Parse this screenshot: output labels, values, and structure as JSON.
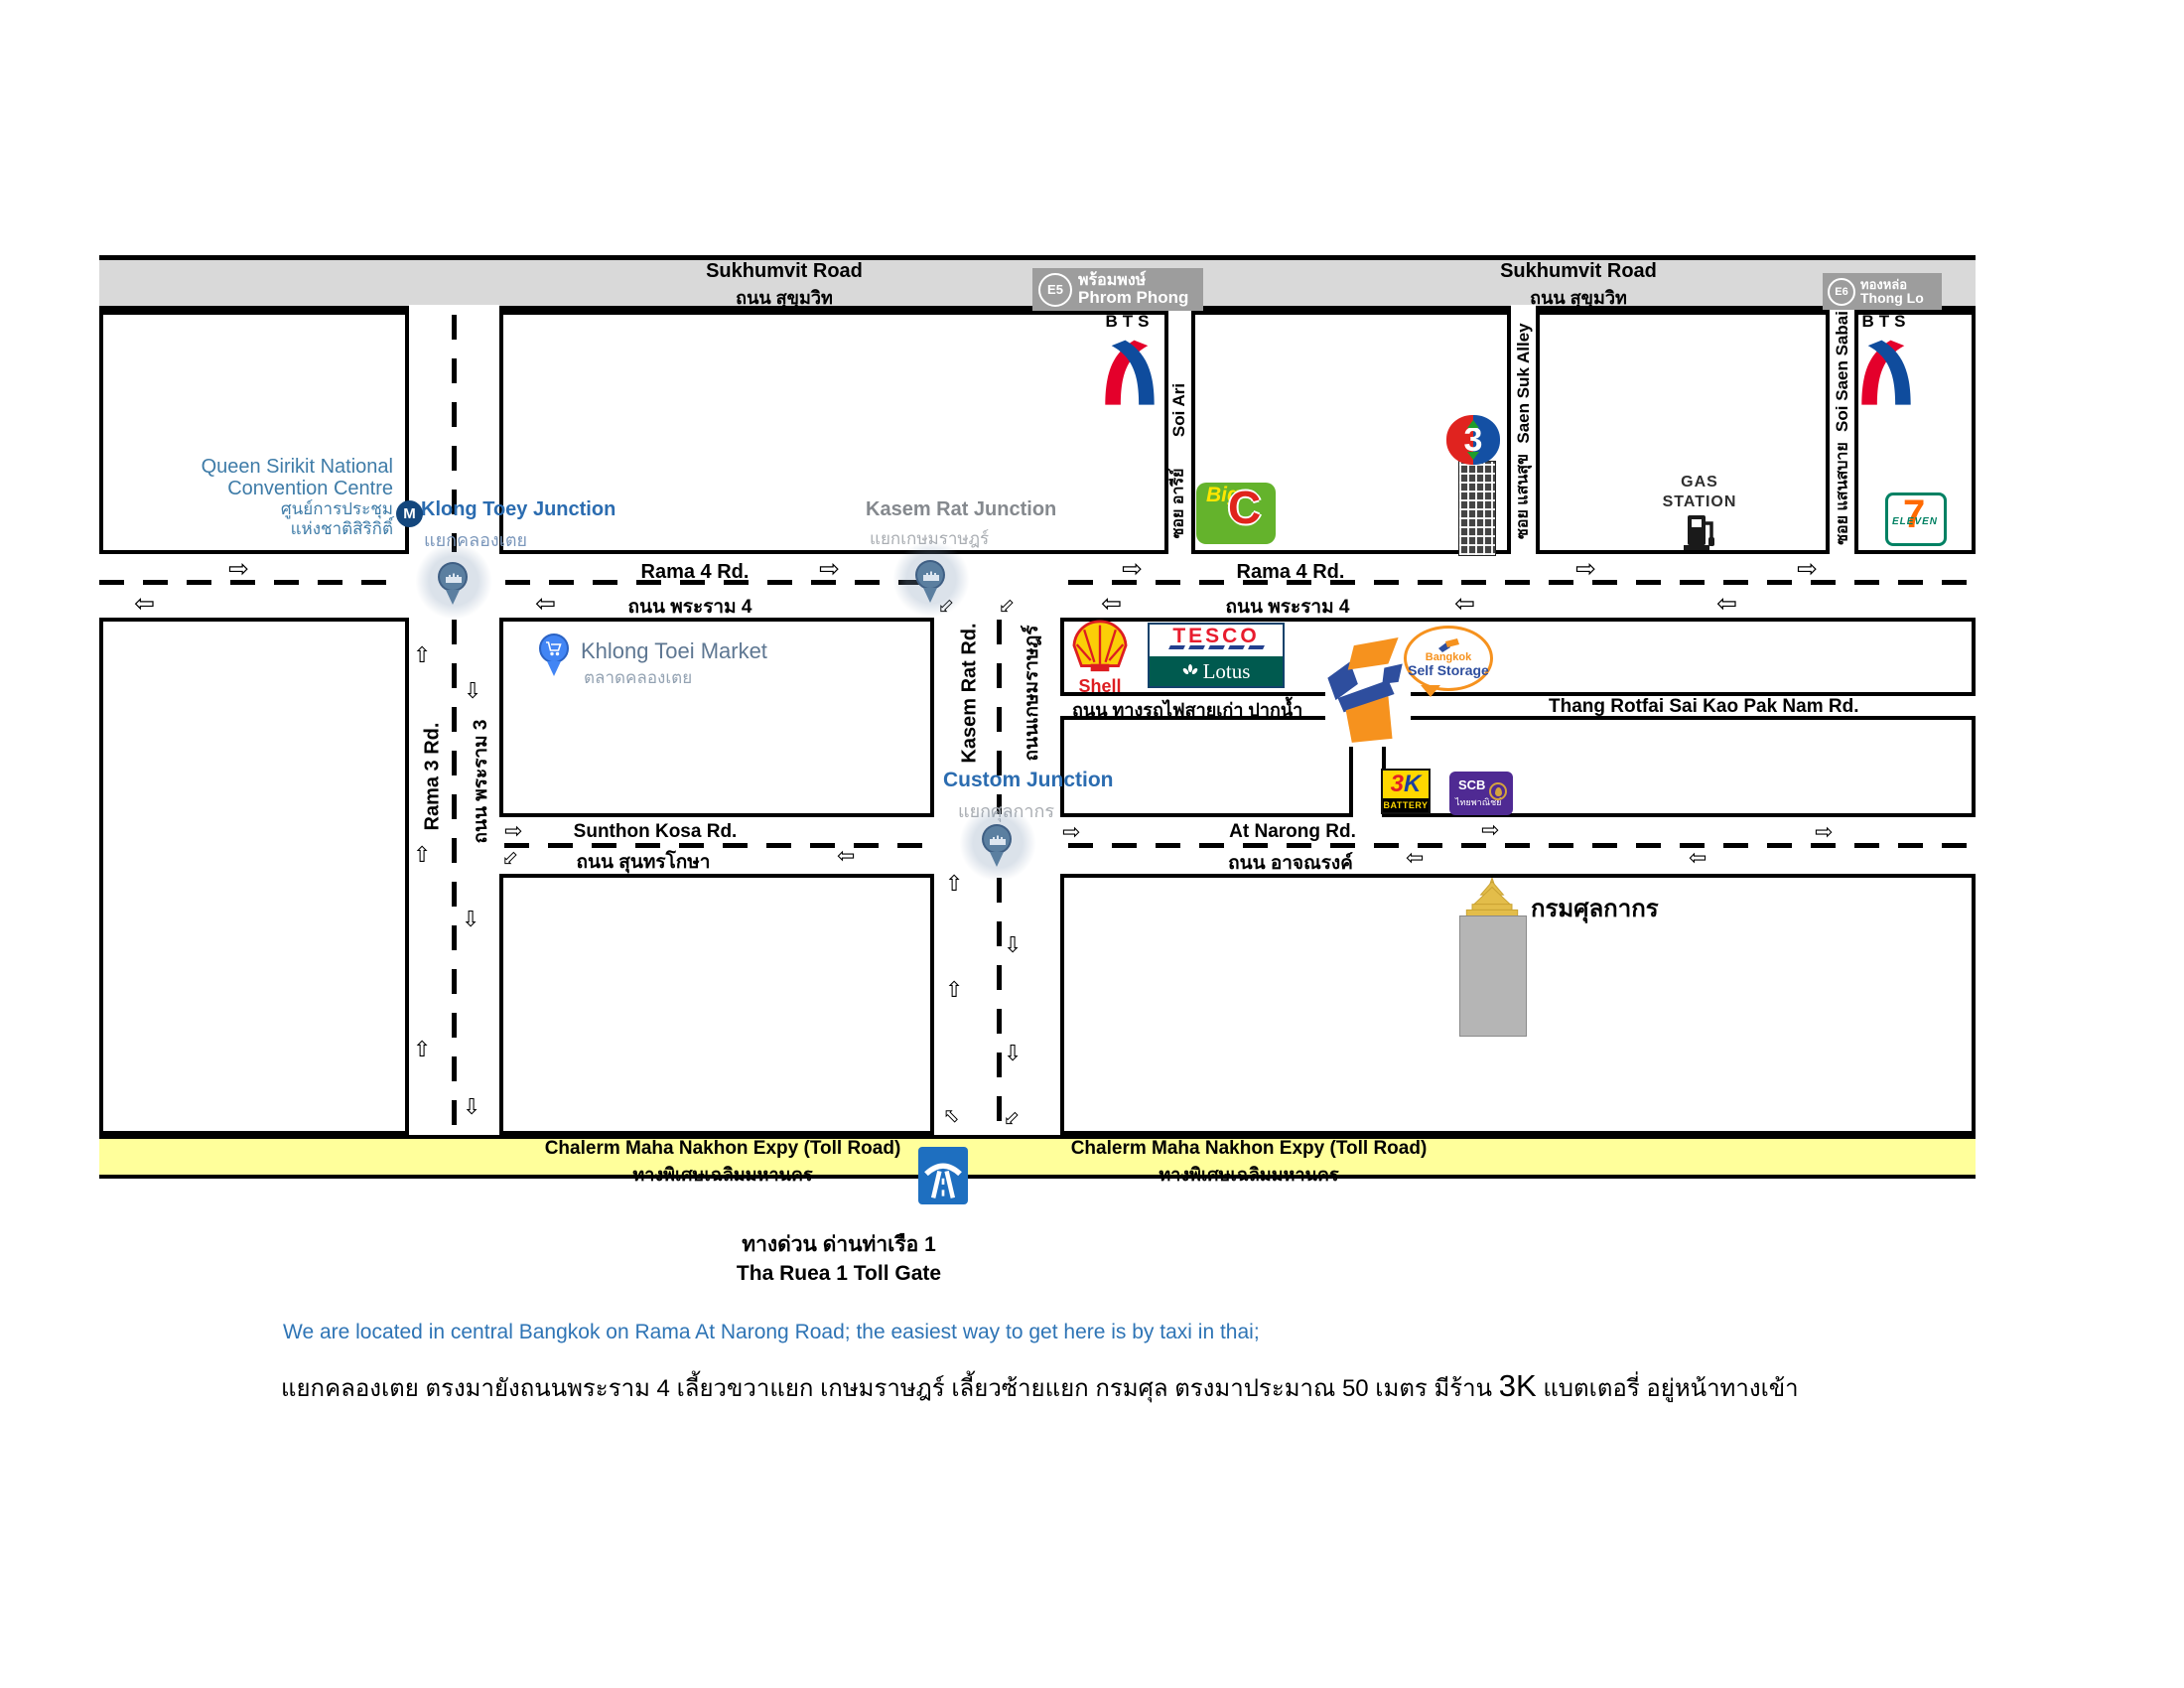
{
  "colors": {
    "road_fill": "#d9d9d9",
    "expressway_fill": "#ffff9b",
    "kerb": "#000000",
    "junction_blue": "#2b6cb0",
    "junction_gray": "#85898e",
    "maps_label_blue": "#3f7ca8",
    "market_label": "#5e7792",
    "shell_red": "#dd1d21",
    "shell_yellow": "#fbce07",
    "tesco_red": "#e81c2e",
    "lotus_teal": "#005a4f",
    "bigc_green": "#64b32c",
    "bigc_red": "#e0241c",
    "scb_purple": "#4f2a93",
    "seven_green": "#008163",
    "seven_orange": "#ff6a00",
    "bts_red": "#e4002b",
    "bts_blue": "#0f4c9d",
    "storage_orange": "#f6921e",
    "storage_blue": "#2e4e9e",
    "pin_blue": "#4285f4",
    "pin_steel": "#5b7fa0",
    "ch3_red": "#e0231f",
    "ch3_blue": "#1450a4",
    "badge_gray": "#9d9d9d",
    "battery_yellow": "#ffd800",
    "note_blue": "#2e74b5"
  },
  "sukhumvit": {
    "en": "Sukhumvit Road",
    "th": "ถนน สุขุมวิท"
  },
  "stations": {
    "bts": "BTS",
    "mrt": "M",
    "phrom_phong": {
      "code": "E5",
      "th": "พร้อมพงษ์",
      "en": "Phrom Phong"
    },
    "thong_lo": {
      "code": "E6",
      "th": "ทองหล่อ",
      "en": "Thong Lo"
    }
  },
  "roads": {
    "rama4": {
      "en": "Rama 4 Rd.",
      "th": "ถนน พระราม 4"
    },
    "rama3": {
      "en": "Rama 3 Rd.",
      "th": "ถนน พระราม 3"
    },
    "kasem_rat": {
      "en": "Kasem Rat Rd.",
      "th": "ถนนเกษมราษฎร์"
    },
    "soi_ari": {
      "en": "Soi Ari",
      "th": "ซอย อารีย์"
    },
    "saen_suk": {
      "en": "Saen Suk Alley",
      "th": "ซอย แสนสุข"
    },
    "saen_sabai": {
      "en": "Soi Saen Sabai",
      "th": "ซอย แสนสบาย"
    },
    "sunthon_kosa": {
      "en": "Sunthon Kosa Rd.",
      "th": "ถนน สุนทรโกษา"
    },
    "at_narong": {
      "en": "At Narong Rd.",
      "th": "ถนน อาจณรงค์"
    },
    "railway": {
      "th": "ถนน ทางรถไฟสายเก่า ปากน้ำ",
      "en": "Thang Rotfai Sai Kao Pak Nam Rd."
    },
    "expressway": {
      "en": "Chalerm Maha Nakhon Expy (Toll Road)",
      "th": "ทางพิเศษเฉลิมมหานคร"
    }
  },
  "junctions": {
    "klong_toey": {
      "en": "Klong Toey Junction",
      "th": "แยกคลองเตย"
    },
    "kasem_rat": {
      "en": "Kasem Rat Junction",
      "th": "แยกเกษมราษฎร์"
    },
    "custom": {
      "en": "Custom Junction",
      "th": "แยกศุลกากร"
    }
  },
  "landmarks": {
    "qsncc": {
      "line1": "Queen Sirikit National",
      "line2": "Convention Centre",
      "th1": "ศูนย์การประชุม",
      "th2": "แห่งชาติสิริกิติ์"
    },
    "market": {
      "en": "Khlong Toei Market",
      "th": "ตลาดคลองเตย"
    },
    "customs_dept": "กรมศุลกากร",
    "gas_station": {
      "line1": "GAS",
      "line2": "STATION"
    },
    "toll_gate": {
      "th": "ทางด่วน ด่านท่าเรือ 1",
      "en": "Tha Ruea 1 Toll Gate"
    }
  },
  "brands": {
    "big_c": {
      "big": "Big",
      "c": "C"
    },
    "shell": "Shell",
    "tesco": "TESCO",
    "lotus": "Lotus",
    "self_storage": {
      "bangkok": "Bangkok",
      "name": "Self Storage"
    },
    "battery_3k": {
      "n3": "3",
      "k": "K",
      "battery": "BATTERY"
    },
    "scb": {
      "en": "SCB",
      "th": "ไทยพาณิชย์"
    },
    "seven": {
      "seven": "7",
      "eleven": "ELEVEN"
    },
    "ch3": "3"
  },
  "notes": {
    "en": "We are located in central Bangkok on Rama At Narong Road; the easiest way to get here is by taxi in thai;",
    "th_pre": "แยกคลองเตย ตรงมายังถนนพระราม 4 เลี้ยวขวาแยก เกษมราษฎร์ เลี้ยวซ้ายแยก กรมศุล ตรงมาประมาณ 50 เมตร มีร้าน ",
    "th_big": "3K",
    "th_post": " แบตเตอรี่ อยู่หน้าทางเข้า"
  },
  "icons": {
    "arrow_right": "⇨",
    "arrow_left": "⇦",
    "arrow_up": "⇧",
    "arrow_down": "⇩"
  }
}
